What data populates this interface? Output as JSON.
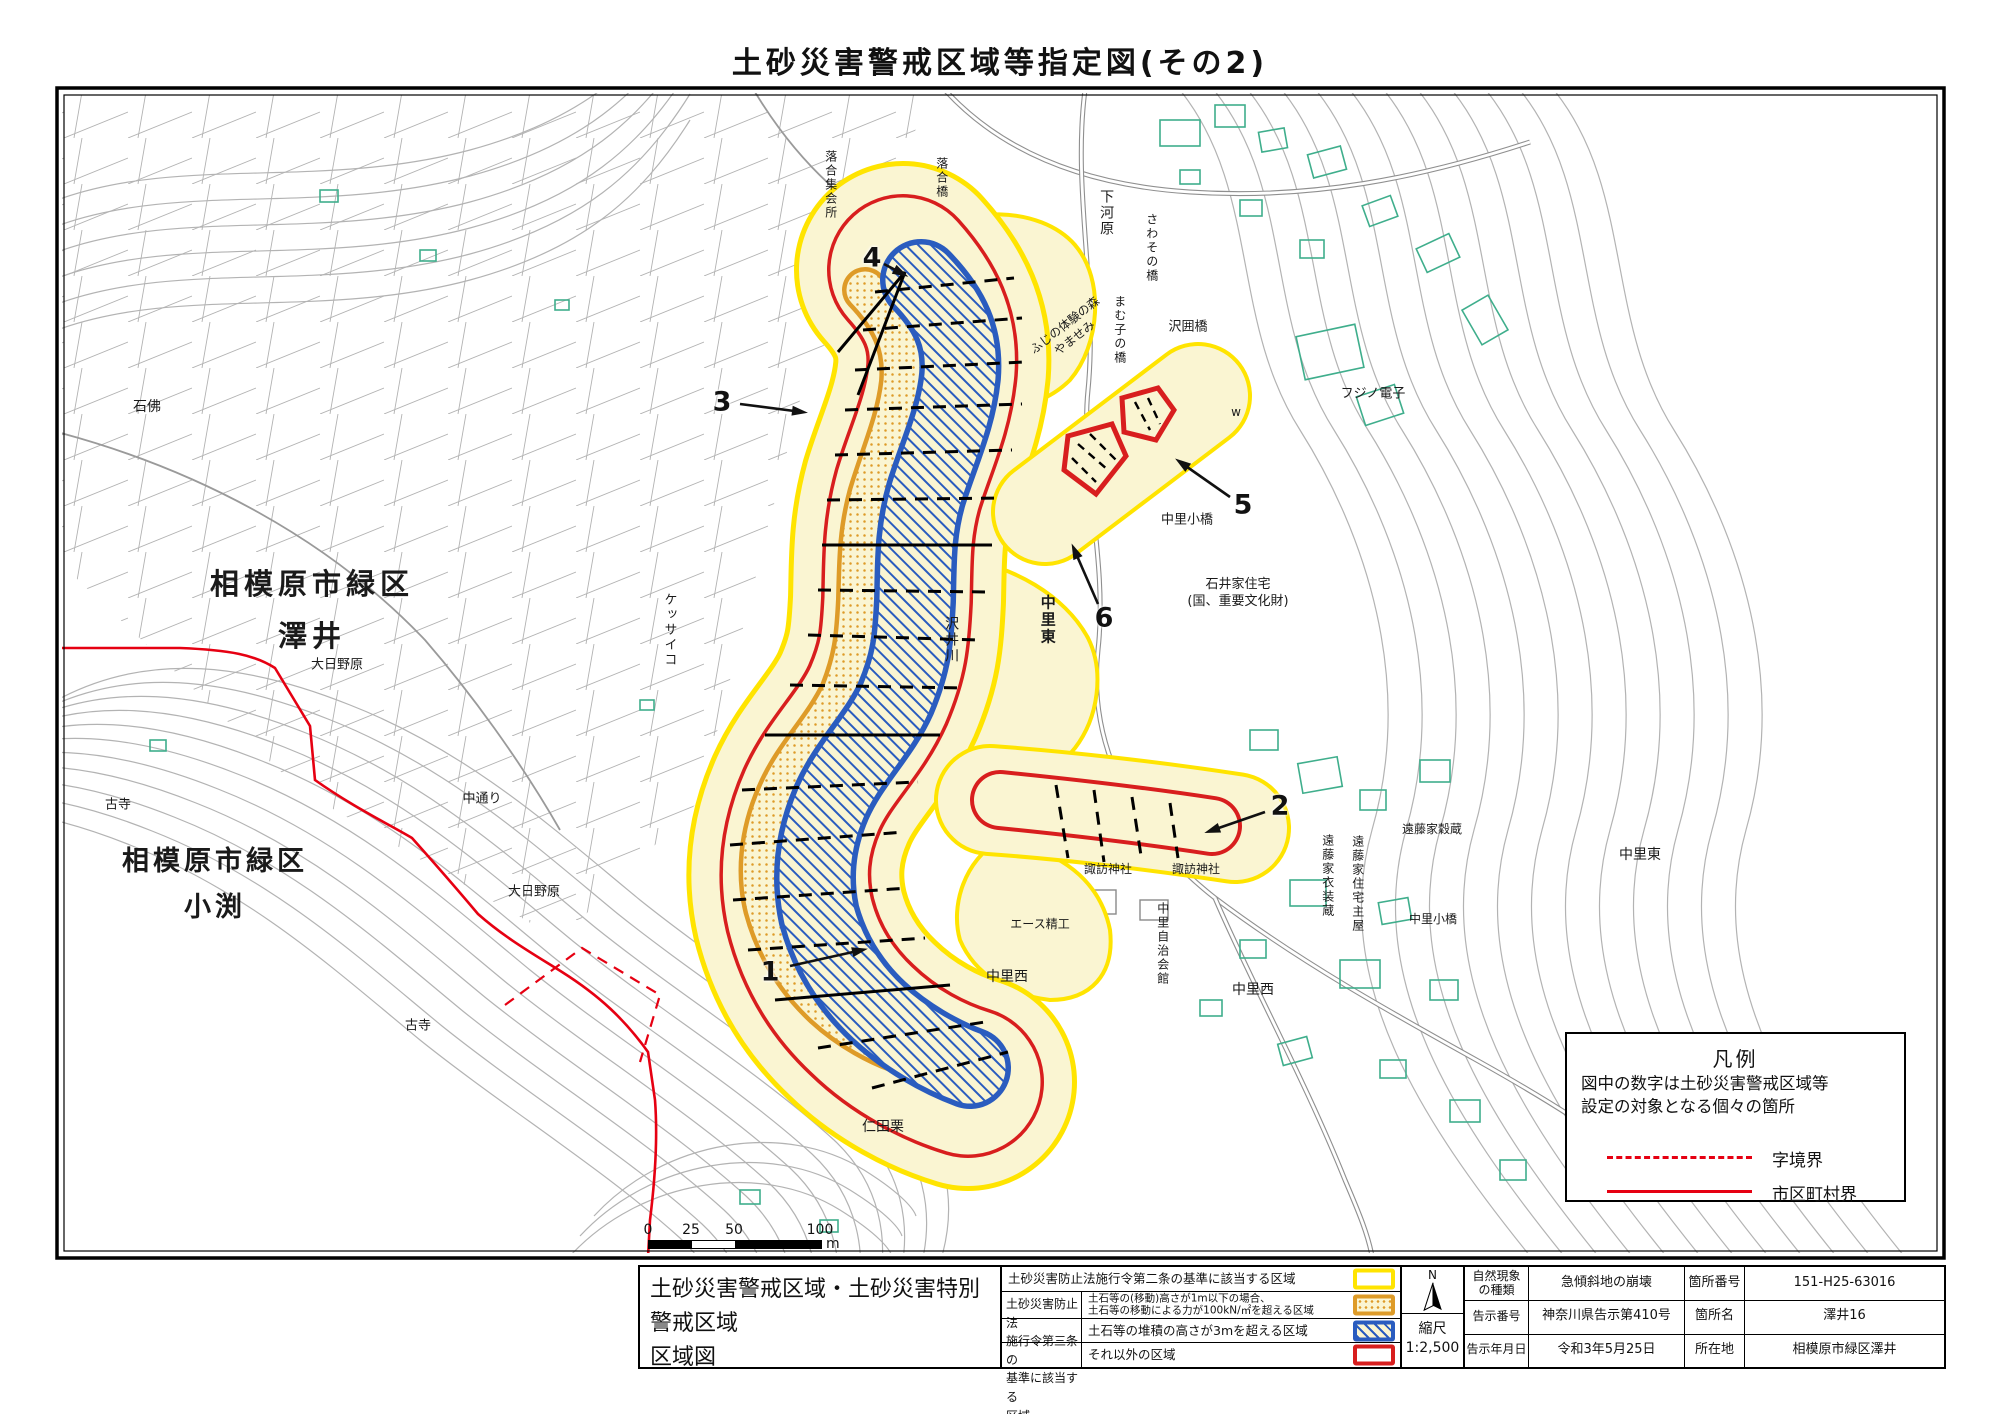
{
  "page": {
    "title": "土砂災害警戒区域等指定図(その2)"
  },
  "colors": {
    "warning_yellow_border": "#FFE400",
    "zone_fill_pale_yellow": "#FAF5D2",
    "special_red": "#D81E1E",
    "orange_zone": "#DE9B28",
    "blue_zone": "#2A5CBF",
    "municipal_boundary_red": "#E60012",
    "building_teal": "#3FAE8C",
    "contour_gray": "#B3B3B3"
  },
  "legend_box": {
    "title": "凡例",
    "line1": "図中の数字は土砂災害警戒区域等",
    "line2": "設定の対象となる個々の箇所",
    "dashed_label": "字境界",
    "solid_label": "市区町村界"
  },
  "scalebar": {
    "ticks": [
      "0",
      "25",
      "50",
      "100"
    ],
    "unit": "m"
  },
  "bottom": {
    "map_title_line1": "土砂災害警戒区域・土砂災害特別警戒区域",
    "map_title_line2": "区域図",
    "legend_group_label": "土砂災害防止法\n施行令第三条の\n基準に該当する\n区域",
    "legend_rows": [
      {
        "text": "土砂災害防止法施行令第二条の基準に該当する区域",
        "swatch": "yellow"
      },
      {
        "text1": "土石等の(移動)高さが1m以下の場合、",
        "text2": "土石等の移動による力が100kN/㎡を超える区域",
        "swatch": "orange"
      },
      {
        "text": "土石等の堆積の高さが3mを超える区域",
        "swatch": "blue"
      },
      {
        "text": "それ以外の区域",
        "swatch": "red"
      }
    ],
    "north_label": "N",
    "scale_label": "縮尺",
    "scale_value": "1:2,500",
    "meta": {
      "rows": [
        {
          "k1": "自然現象\nの種類",
          "v1": "急傾斜地の崩壊",
          "k2": "箇所番号",
          "v2": "151-H25-63016"
        },
        {
          "k1": "告示番号",
          "v1": "神奈川県告示第410号",
          "k2": "箇所名",
          "v2": "澤井16"
        },
        {
          "k1": "告示年月日",
          "v1": "令和3年5月25日",
          "k2": "所在地",
          "v2": "相模原市緑区澤井"
        }
      ]
    }
  },
  "map_labels": [
    {
      "t": "落合集会所",
      "x": 830,
      "y": 185,
      "v": 1,
      "s": 12
    },
    {
      "t": "落合橋",
      "x": 941,
      "y": 178,
      "v": 1,
      "s": 12
    },
    {
      "t": "下河原",
      "x": 1106,
      "y": 213,
      "v": 1,
      "s": 14
    },
    {
      "t": "さわその橋",
      "x": 1151,
      "y": 248,
      "v": 1,
      "s": 12
    },
    {
      "t": "まむ子の橋",
      "x": 1119,
      "y": 330,
      "v": 1,
      "s": 12
    },
    {
      "t": "沢囲橋",
      "x": 1188,
      "y": 328,
      "s": 13
    },
    {
      "t": "ふじの体験の森\nやませみ",
      "x": 1070,
      "y": 332,
      "r": -38,
      "s": 12
    },
    {
      "t": "フジノ電子",
      "x": 1373,
      "y": 395,
      "s": 13
    },
    {
      "t": "w",
      "x": 1236,
      "y": 413,
      "s": 12
    },
    {
      "t": "石井家住宅\n(国、重要文化財)",
      "x": 1238,
      "y": 594,
      "s": 13
    },
    {
      "t": "中里小橋",
      "x": 1187,
      "y": 521,
      "s": 13
    },
    {
      "t": "中里東",
      "x": 1047,
      "y": 620,
      "v": 1,
      "s": 15,
      "b": 1
    },
    {
      "t": "沢井川",
      "x": 951,
      "y": 640,
      "v": 1,
      "s": 14
    },
    {
      "t": "石佛",
      "x": 147,
      "y": 407,
      "s": 14
    },
    {
      "t": "相模原市緑区\n澤井",
      "x": 312,
      "y": 610,
      "s": 29,
      "b": 1,
      "ls": 5,
      "lh": 1.8
    },
    {
      "t": "大日野原",
      "x": 337,
      "y": 666,
      "s": 13
    },
    {
      "t": "古寺",
      "x": 118,
      "y": 806,
      "s": 13
    },
    {
      "t": "相模原市緑区\n小渕",
      "x": 215,
      "y": 885,
      "s": 27,
      "b": 1,
      "ls": 4,
      "lh": 1.7
    },
    {
      "t": "中通り",
      "x": 482,
      "y": 800,
      "s": 13
    },
    {
      "t": "大日野原",
      "x": 534,
      "y": 893,
      "s": 13
    },
    {
      "t": "古寺",
      "x": 418,
      "y": 1027,
      "s": 13
    },
    {
      "t": "仁田栗",
      "x": 883,
      "y": 1127,
      "s": 14
    },
    {
      "t": "ケッサイコ",
      "x": 668,
      "y": 630,
      "v": 1,
      "s": 13
    },
    {
      "t": "中里西",
      "x": 1007,
      "y": 977,
      "s": 14
    },
    {
      "t": "中里西",
      "x": 1253,
      "y": 990,
      "s": 14
    },
    {
      "t": "中里自治会館",
      "x": 1162,
      "y": 944,
      "v": 1,
      "s": 12
    },
    {
      "t": "諏訪神社",
      "x": 1108,
      "y": 870,
      "s": 12
    },
    {
      "t": "諏訪神社",
      "x": 1196,
      "y": 870,
      "s": 12
    },
    {
      "t": "エース精工",
      "x": 1040,
      "y": 925,
      "s": 12
    },
    {
      "t": "遠藤家穀蔵",
      "x": 1432,
      "y": 830,
      "s": 12
    },
    {
      "t": "遠藤家衣装蔵",
      "x": 1327,
      "y": 876,
      "v": 1,
      "s": 12
    },
    {
      "t": "遠藤家住宅主屋",
      "x": 1357,
      "y": 884,
      "v": 1,
      "s": 12
    },
    {
      "t": "中里小橋",
      "x": 1433,
      "y": 920,
      "s": 12
    },
    {
      "t": "中里東",
      "x": 1640,
      "y": 855,
      "s": 14
    }
  ],
  "numbers": [
    {
      "n": "1",
      "x": 770,
      "y": 972,
      "a": [
        790,
        966,
        862,
        950
      ]
    },
    {
      "n": "2",
      "x": 1280,
      "y": 806,
      "a": [
        1265,
        812,
        1210,
        831
      ]
    },
    {
      "n": "3",
      "x": 722,
      "y": 402,
      "a": [
        740,
        404,
        802,
        412
      ]
    },
    {
      "n": "4",
      "x": 872,
      "y": 258,
      "a": [
        884,
        264,
        903,
        274
      ]
    },
    {
      "n": "5",
      "x": 1243,
      "y": 505,
      "a": [
        1230,
        497,
        1180,
        462
      ]
    },
    {
      "n": "6",
      "x": 1104,
      "y": 618,
      "a": [
        1098,
        604,
        1074,
        549
      ]
    }
  ]
}
